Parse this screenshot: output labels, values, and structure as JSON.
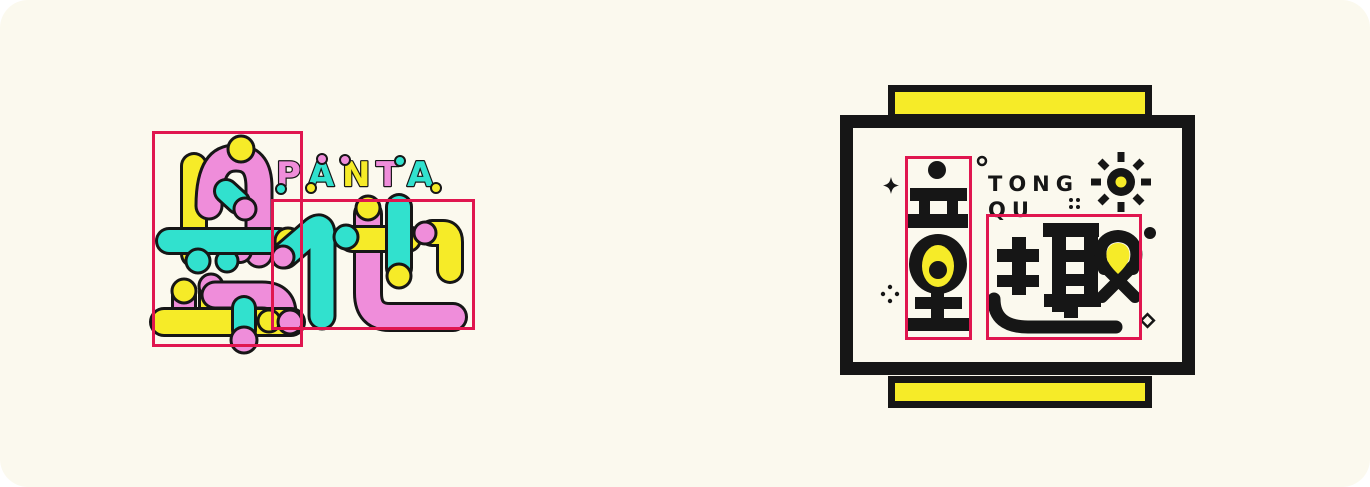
{
  "page": {
    "background_color": "#FBF9EE",
    "outer_color": "#ffffff"
  },
  "colors": {
    "pink": "#EF8DDA",
    "cyan": "#31E1CE",
    "yellow": "#F6EB28",
    "ink": "#161616",
    "annotation_red": "#E0164F",
    "cream": "#FBF9EE"
  },
  "left_logo": {
    "name": "PANTA tube logotype",
    "brand_text": "PANTA",
    "letters": [
      {
        "char": "P",
        "color": "#EF8DDA"
      },
      {
        "char": "A",
        "color": "#31E1CE"
      },
      {
        "char": "N",
        "color": "#F6EB28"
      },
      {
        "char": "T",
        "color": "#EF8DDA"
      },
      {
        "char": "A",
        "color": "#31E1CE"
      }
    ]
  },
  "right_logo": {
    "name": "TONG QU framed logotype",
    "line1": "TONG",
    "line2": "QU",
    "characters": "童趣",
    "icons": [
      "sun-icon",
      "sparkle-icon",
      "ring-icon",
      "four-dots-icon",
      "five-dots-icon",
      "dot-icon",
      "diamond-icon"
    ]
  },
  "annotations": {
    "boxes": [
      {
        "id": "panta-char-box-1",
        "x": 152,
        "y": 131,
        "w": 151,
        "h": 216
      },
      {
        "id": "panta-char-box-2",
        "x": 271,
        "y": 199,
        "w": 204,
        "h": 131
      },
      {
        "id": "tongqu-char-box-1",
        "x": 905,
        "y": 156,
        "w": 67,
        "h": 184
      },
      {
        "id": "tongqu-char-box-2",
        "x": 986,
        "y": 214,
        "w": 156,
        "h": 126
      }
    ]
  }
}
